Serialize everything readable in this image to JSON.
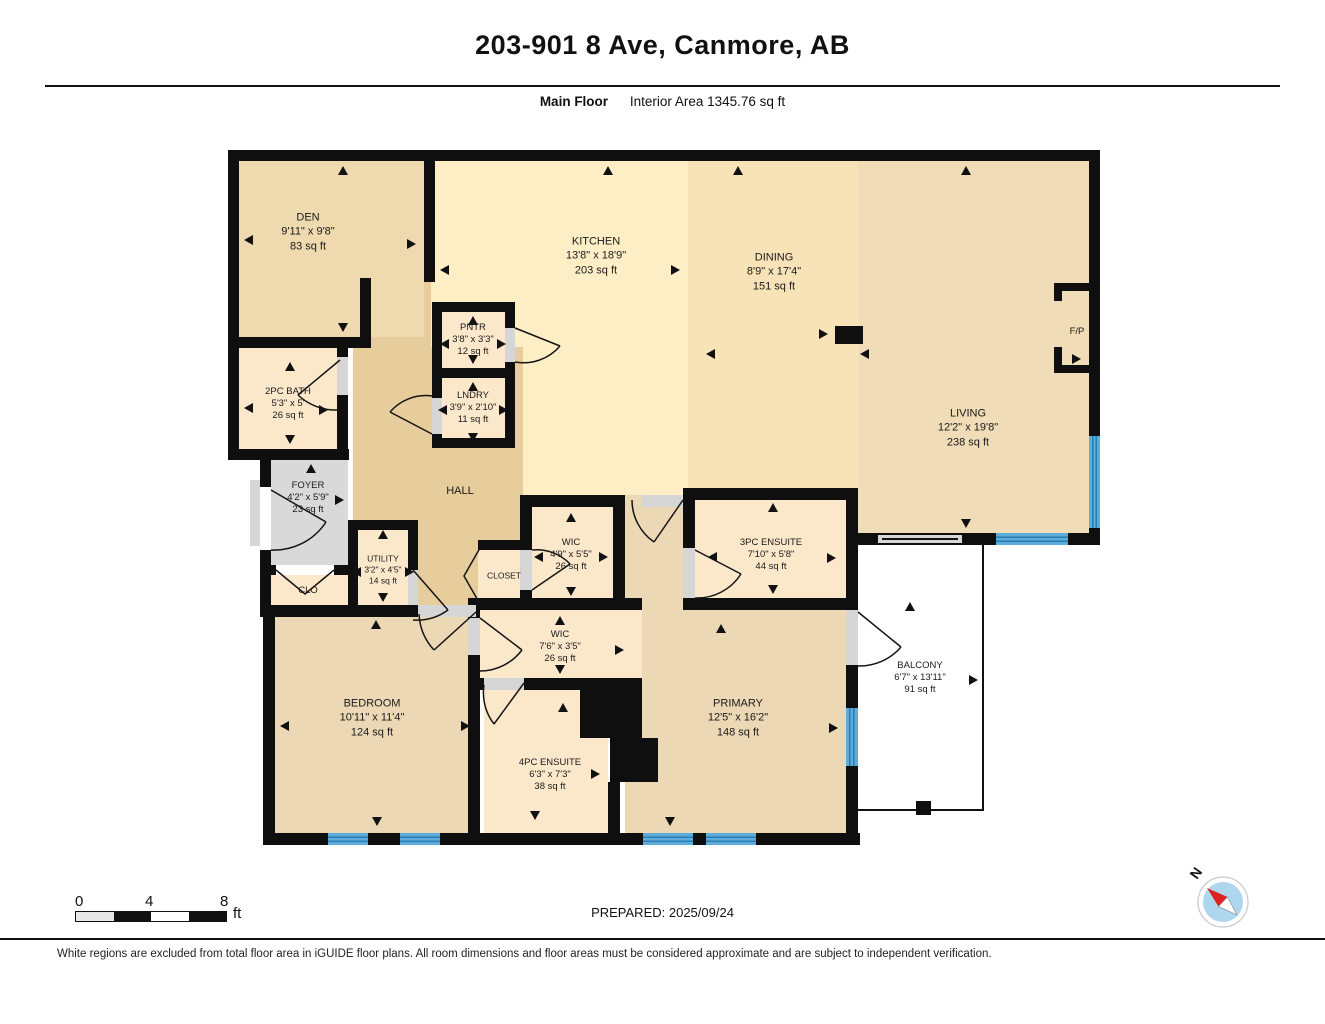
{
  "header": {
    "title": "203-901 8 Ave, Canmore, AB",
    "floor_label": "Main Floor",
    "interior_area": "Interior Area 1345.76 sq ft"
  },
  "rooms": [
    {
      "name": "DEN",
      "dims": "9'11\" x 9'8\"",
      "area": "83 sq ft"
    },
    {
      "name": "KITCHEN",
      "dims": "13'8\" x 18'9\"",
      "area": "203 sq ft"
    },
    {
      "name": "DINING",
      "dims": "8'9\" x 17'4\"",
      "area": "151 sq ft"
    },
    {
      "name": "LIVING",
      "dims": "12'2\" x 19'8\"",
      "area": "238 sq ft"
    },
    {
      "name": "F/P",
      "dims": "",
      "area": ""
    },
    {
      "name": "PNTR",
      "dims": "3'8\" x 3'3\"",
      "area": "12 sq ft"
    },
    {
      "name": "LNDRY",
      "dims": "3'9\" x 2'10\"",
      "area": "11 sq ft"
    },
    {
      "name": "2PC BATH",
      "dims": "5'3\" x 5'",
      "area": "26 sq ft"
    },
    {
      "name": "FOYER",
      "dims": "4'2\" x 5'9\"",
      "area": "23 sq ft"
    },
    {
      "name": "HALL",
      "dims": "",
      "area": ""
    },
    {
      "name": "UTILITY",
      "dims": "3'2\" x 4'5\"",
      "area": "14 sq ft"
    },
    {
      "name": "CLO",
      "dims": "",
      "area": ""
    },
    {
      "name": "CLOSET",
      "dims": "",
      "area": ""
    },
    {
      "name": "WIC",
      "dims": "4'9\" x 5'5\"",
      "area": "26 sq ft"
    },
    {
      "name": "3PC ENSUITE",
      "dims": "7'10\" x 5'8\"",
      "area": "44 sq ft"
    },
    {
      "name": "WIC",
      "dims": "7'6\" x 3'5\"",
      "area": "26 sq ft"
    },
    {
      "name": "BEDROOM",
      "dims": "10'11\" x 11'4\"",
      "area": "124 sq ft"
    },
    {
      "name": "4PC ENSUITE",
      "dims": "6'3\" x 7'3\"",
      "area": "38 sq ft"
    },
    {
      "name": "PRIMARY",
      "dims": "12'5\" x 16'2\"",
      "area": "148 sq ft"
    },
    {
      "name": "BALCONY",
      "dims": "6'7\" x 13'11\"",
      "area": "91 sq ft"
    }
  ],
  "scale_bar": {
    "labels": [
      "0",
      "4",
      "8"
    ],
    "unit": "ft"
  },
  "compass": {
    "label": "N"
  },
  "footer": {
    "prepared": "PREPARED: 2025/09/24",
    "disclaimer": "White regions are excluded from total floor area in iGUIDE floor plans. All room dimensions and floor areas must be considered approximate and are subject to independent verification."
  },
  "colors": {
    "wall": "#0f0f0f",
    "kitchen": "#fdeec6",
    "dining": "#f8e3b8",
    "living": "#f0dcb6",
    "den": "#efd9ae",
    "hall": "#e7cc9c",
    "bedrooms": "#ecd8b5",
    "small_rooms": "#fbe8cb",
    "foyer": "#d9d9d9",
    "window": "#5cadd9",
    "balcony": "#ffffff"
  }
}
